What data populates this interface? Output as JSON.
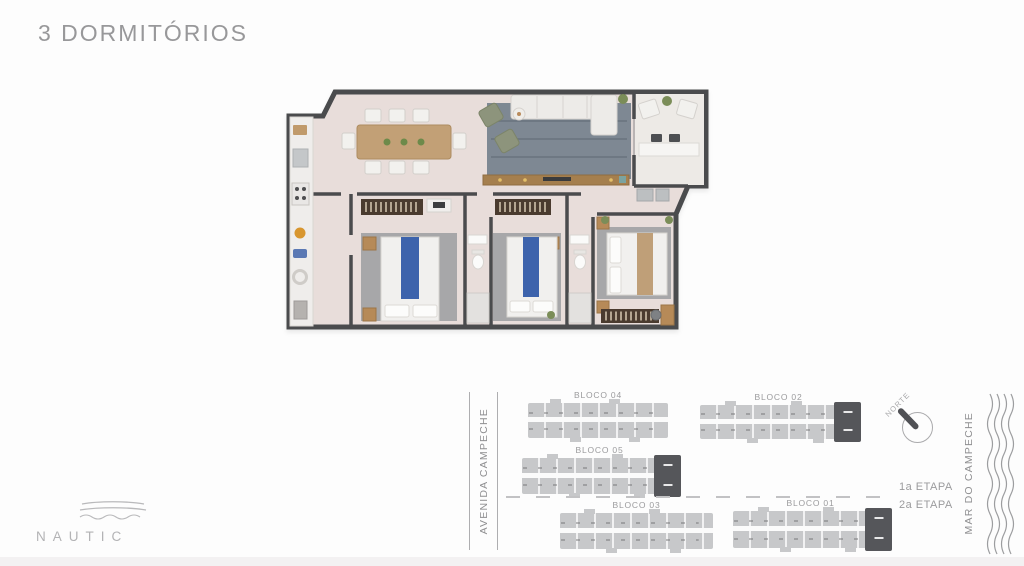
{
  "page": {
    "title": "3 DORMITÓRIOS",
    "background_color": "#fdfdfd"
  },
  "brand": {
    "name": "NAUTIC"
  },
  "floor_plan": {
    "description": "3-bedroom apartment floor plan, furnished top view",
    "rooms": [
      "kitchen",
      "dining room",
      "living room",
      "balcony",
      "bedroom 1",
      "bedroom 2",
      "master bedroom",
      "bathroom 1",
      "bathroom 2"
    ],
    "colors": {
      "floor": "#e8ddda",
      "balcony_floor": "#edeae6",
      "walls": "#4a4b4d",
      "living_rug": "#7e8893",
      "bedroom_rug": "#a7a7a9",
      "wood": "#c2a076",
      "wardrobe": "#4a3b2f",
      "bed_accent_blue": "#3d63ac",
      "armchair_green": "#8d947c"
    }
  },
  "site_plan": {
    "street_label": "AVENIDA CAMPECHE",
    "sea_label": "MAR DO CAMPECHE",
    "north_label": "NORTE",
    "stage1_label": "1a ETAPA",
    "stage2_label": "2a ETAPA",
    "blocks": [
      {
        "label": "BLOCO 04",
        "highlighted_unit": false
      },
      {
        "label": "BLOCO 02",
        "highlighted_unit": true
      },
      {
        "label": "BLOCO 05",
        "highlighted_unit": true
      },
      {
        "label": "BLOCO 03",
        "highlighted_unit": false
      },
      {
        "label": "BLOCO 01",
        "highlighted_unit": true
      }
    ],
    "colors": {
      "building": "#c7c8ca",
      "highlighted_unit": "#55565a",
      "labels": "#9b9b9d"
    }
  }
}
